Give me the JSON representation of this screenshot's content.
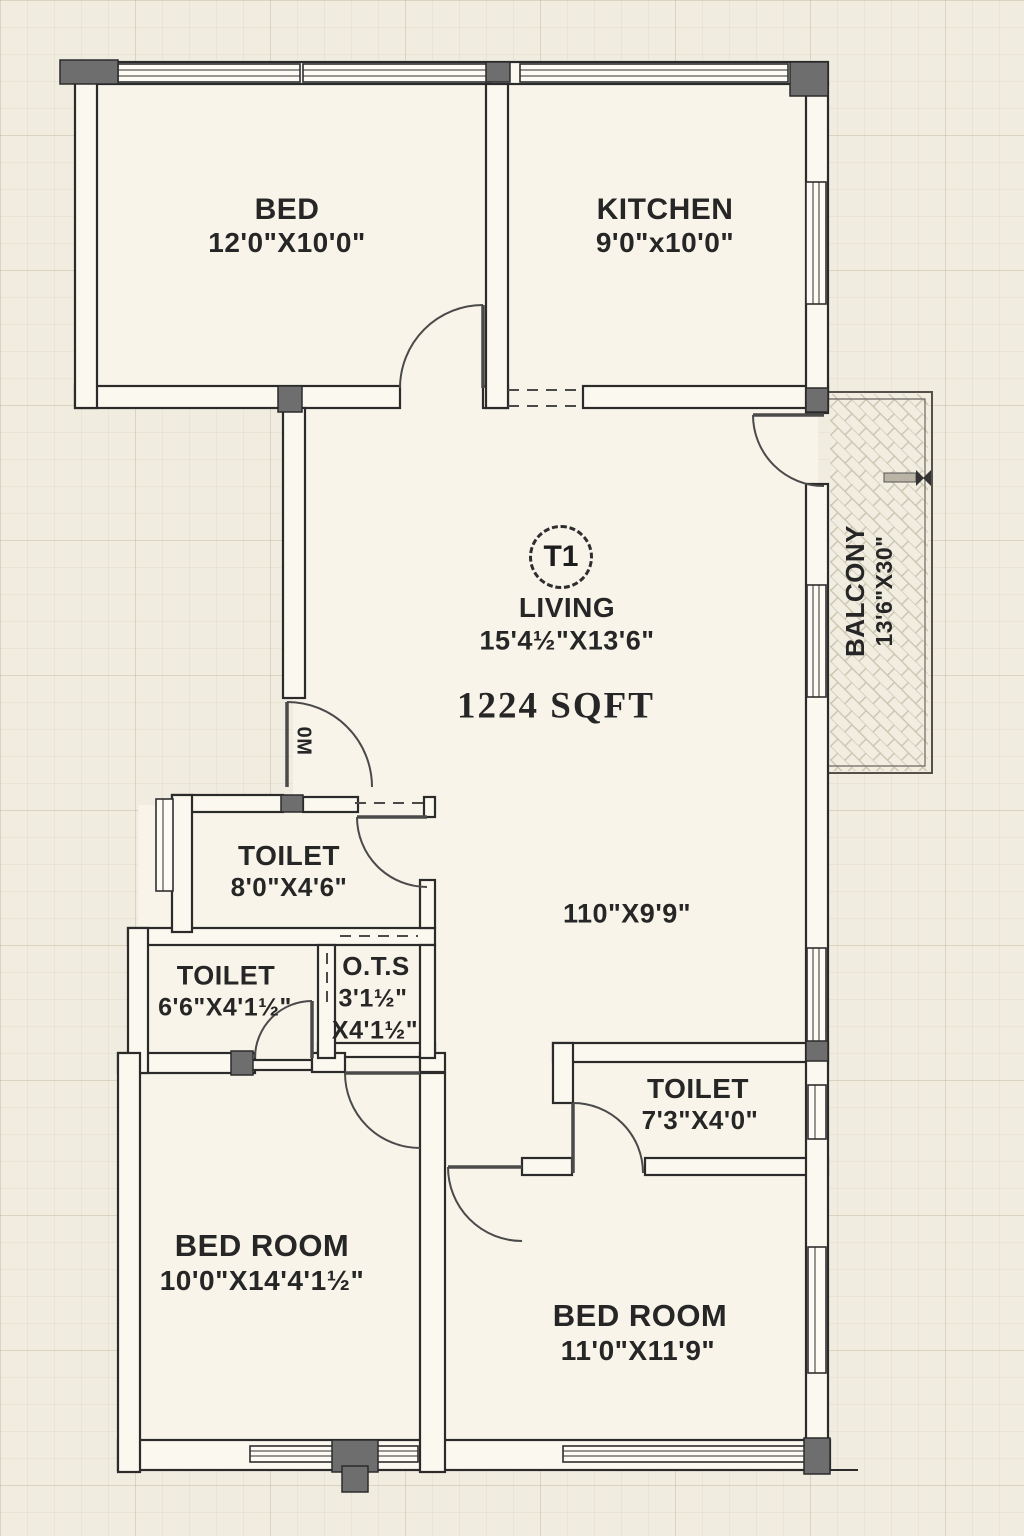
{
  "plan": {
    "unit_badge": "T1",
    "area_label": "1224 SQFT",
    "door_label": "0M",
    "living_extra_dim": "110\"X9'9\"",
    "rooms": {
      "bed_top": {
        "name": "BED",
        "dims": "12'0\"X10'0\""
      },
      "kitchen": {
        "name": "KITCHEN",
        "dims": "9'0\"x10'0\""
      },
      "living": {
        "name": "LIVING",
        "dims": "15'4½\"X13'6\""
      },
      "balcony": {
        "name": "BALCONY",
        "dims": "13'6\"X30\""
      },
      "toilet_top": {
        "name": "TOILET",
        "dims": "8'0\"X4'6\""
      },
      "toilet_left": {
        "name": "TOILET",
        "dims": "6'6\"X4'1½\""
      },
      "ots": {
        "name": "O.T.S",
        "dims_line1": "3'1½\"",
        "dims_line2": "X4'1½\""
      },
      "toilet_right": {
        "name": "TOILET",
        "dims": "7'3\"X4'0\""
      },
      "bedroom_left": {
        "name": "BED ROOM",
        "dims": "10'0\"X14'4'1½\""
      },
      "bedroom_right": {
        "name": "BED ROOM",
        "dims": "11'0\"X11'9\""
      }
    },
    "colors": {
      "paper": "#f1ece0",
      "room_floor": "#f8f4e9",
      "wall_fill": "#fbf8ef",
      "wall_line": "#2b2b2b",
      "column": "#6e6e6e",
      "text": "#262626"
    }
  }
}
